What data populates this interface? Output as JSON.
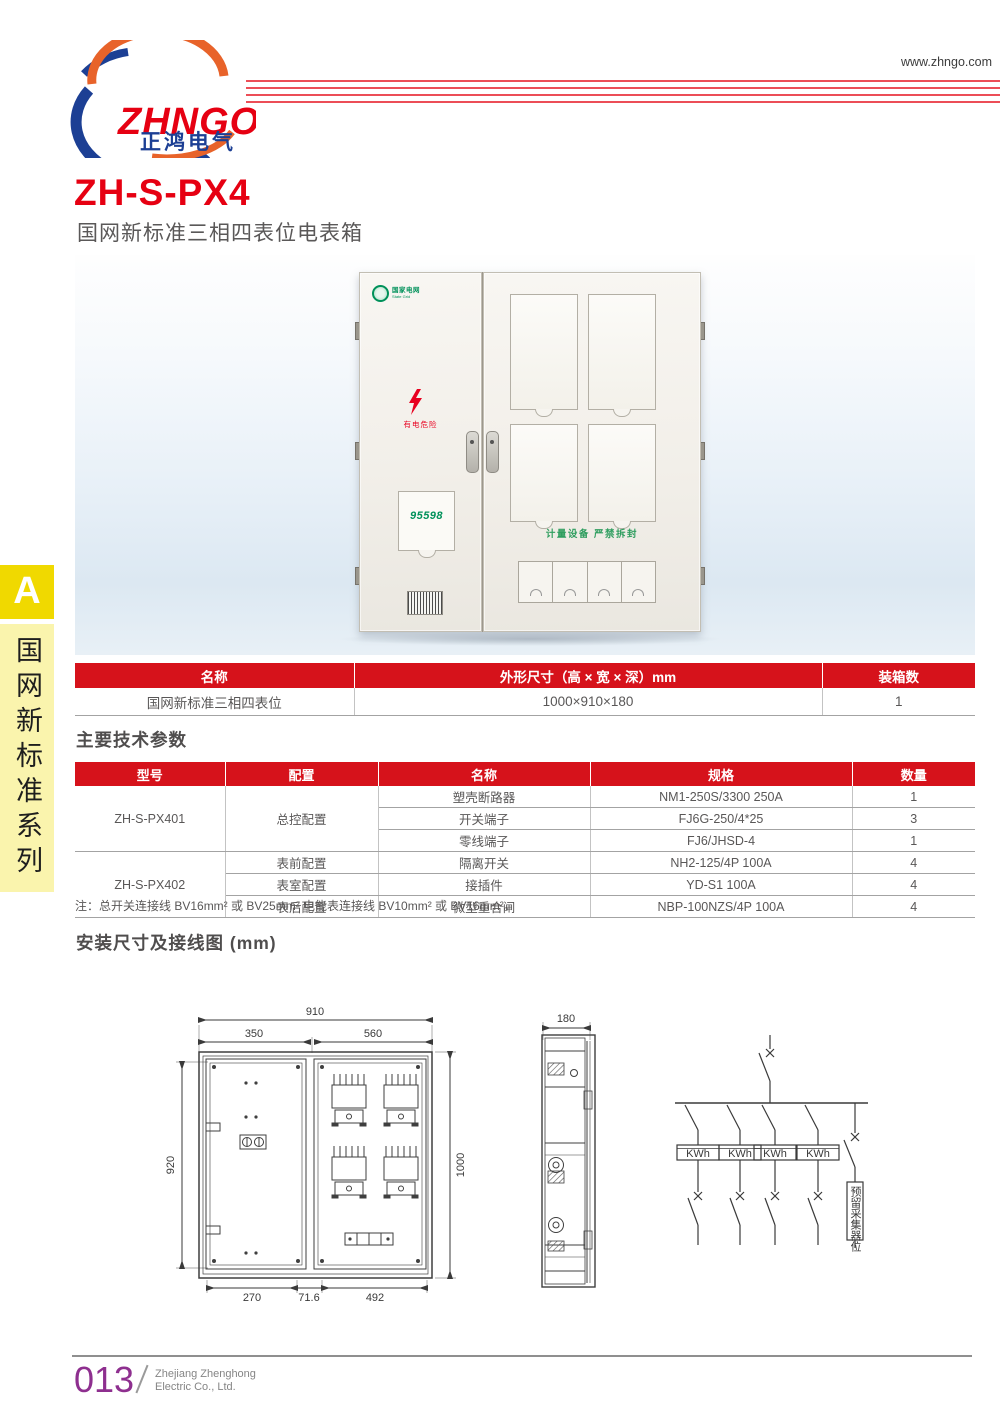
{
  "colors": {
    "accent_red": "#d6121b",
    "title_red": "#e60012",
    "logo_blue": "#1c3f94",
    "logo_orange": "#e8632a",
    "grid_green": "#00915a",
    "sidebar_yellow": "#f0d900",
    "sidebar_pale": "#faf4ad",
    "page_purple": "#8e2f8f"
  },
  "header": {
    "logo_text": "ZHNGO",
    "logo_cn": "正鸿电气",
    "website": "www.zhngo.com"
  },
  "sidebar": {
    "tab_letter": "A",
    "series_label": "国网新标准系列"
  },
  "title": {
    "model": "ZH-S-PX4",
    "subtitle": "国网新标准三相四表位电表箱"
  },
  "product": {
    "grid_logo_cn": "国家电网",
    "grid_logo_en": "State Grid",
    "danger_text": "有电危险",
    "service_number": "95598",
    "seal_text": "计量设备 严禁拆封"
  },
  "size_table": {
    "headers": [
      "名称",
      "外形尺寸（高 × 宽 × 深）mm",
      "装箱数"
    ],
    "row": [
      "国网新标准三相四表位",
      "1000×910×180",
      "1"
    ]
  },
  "tech": {
    "heading": "主要技术参数",
    "headers": [
      "型号",
      "配置",
      "名称",
      "规格",
      "数量"
    ],
    "rows": [
      {
        "model": "ZH-S-PX401",
        "config": "总控配置",
        "name": "塑壳断路器",
        "spec": "NM1-250S/3300 250A",
        "qty": "1"
      },
      {
        "name": "开关端子",
        "spec": "FJ6G-250/4*25",
        "qty": "3"
      },
      {
        "name": "零线端子",
        "spec": "FJ6/JHSD-4",
        "qty": "1"
      },
      {
        "model": "ZH-S-PX402",
        "config": "表前配置",
        "name": "隔离开关",
        "spec": "NH2-125/4P 100A",
        "qty": "4"
      },
      {
        "config": "表室配置",
        "name": "接插件",
        "spec": "YD-S1 100A",
        "qty": "4"
      },
      {
        "config": "表后配置",
        "name": "微型重合闸",
        "spec": "NBP-100NZS/4P 100A",
        "qty": "4"
      }
    ],
    "note": "注：总开关连接线 BV16mm² 或 BV25mm² 电能表连接线 BV10mm² 或 BV16mm²。"
  },
  "install": {
    "heading": "安装尺寸及接线图 (mm)",
    "front": {
      "w_total": "910",
      "w_left": "350",
      "w_right": "560",
      "h_left": "920",
      "h_right": "1000",
      "b_left": "270",
      "b_mid": "71.6",
      "b_right": "492"
    },
    "side": {
      "depth": "180"
    },
    "wiring": {
      "meter": "KWh",
      "reserved": "预留采集器位"
    }
  },
  "footer": {
    "page": "013",
    "company_line1": "Zhejiang Zhenghong",
    "company_line2": "Electric Co., Ltd."
  }
}
